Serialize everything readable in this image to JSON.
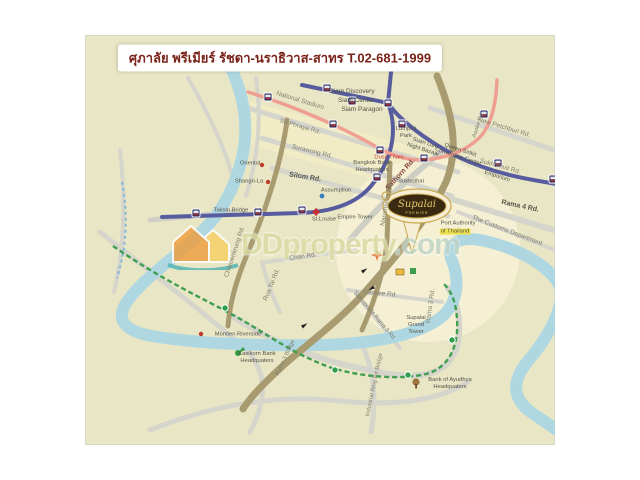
{
  "title": "ศุภาลัย พรีเมียร์ รัชดา-นราธิวาส-สาทร T.02-681-1999",
  "logo": {
    "name": "Supalai",
    "sub": "PREMIER"
  },
  "watermark": {
    "brand": "DDproperty",
    "tld": ".com"
  },
  "colors": {
    "map_bg": "#e9e6c5",
    "river": "#aed7e2",
    "bts_line": "#575c9e",
    "mrt_line": "#ef9e92",
    "brt_line": "#3f9e4f",
    "road_major": "#a89b6f",
    "road_minor": "#d6d5cc",
    "title_text": "#7a241a"
  },
  "labels": {
    "siam_discovery": "Siam Discovery",
    "siam_center": "Siam Center",
    "siam_paragon": "Siam Paragon",
    "national_stadium": "National Stadium",
    "si_phraya": "Sri Phraya Rd.",
    "surawong": "Surawong Rd.",
    "silom": "Silom Rd.",
    "sathorn": "Sathorn Rd.",
    "new_petchburi": "New Petchburi Rd.",
    "sukhumvit": "Sukhumvit Rd.",
    "rama4": "Rama 4 Rd.",
    "asoke": "Asoke Rd.",
    "customs": "The Customs Department",
    "lumpini": "Lumpini\nPark",
    "suan_lum": "Suan Lum\nNight Bazaar",
    "queen_sirikit": "Queen Sirikit\nConvention Center",
    "emporium": "Emporium",
    "dusit_thani": "Dusit Thani",
    "bangkok_bank": "Bangkok Bank\nHeadquaters",
    "sukhothai": "Sukhothai",
    "empire_tower": "Empire Tower",
    "st_louis": "St.Louise",
    "taksin_bridge": "Taksin Bridge",
    "oriental": "Oriental",
    "shangrila": "Shangri-La",
    "assumption": "Assumption",
    "narathiwas": "Narathiwas Rd.",
    "charoenkrung": "Charoenkrung Rd.",
    "rua_tai": "Rua Tai Rd.",
    "chan": "Chan Rd.",
    "nonsee": "Nonsee Rd.",
    "sathupradit": "Sathupradit-Rama 3 Rd.",
    "rama3_rd": "Rama 3 Rd.",
    "supalai_grand": "Supalai\nGrand\nTower",
    "port_authority": "Port Authority",
    "port_authority_2": "of Thailand",
    "montien": "Montien Riverside",
    "kasikorn": "Kasikorn Bank\nHeadquaters",
    "ayudhya": "Bank of Ayudhya\nHeadquaters",
    "rama3_bridge": "Rama 3 Bridge",
    "industrial_ring": "Industrial Ring Rd Bridge"
  }
}
